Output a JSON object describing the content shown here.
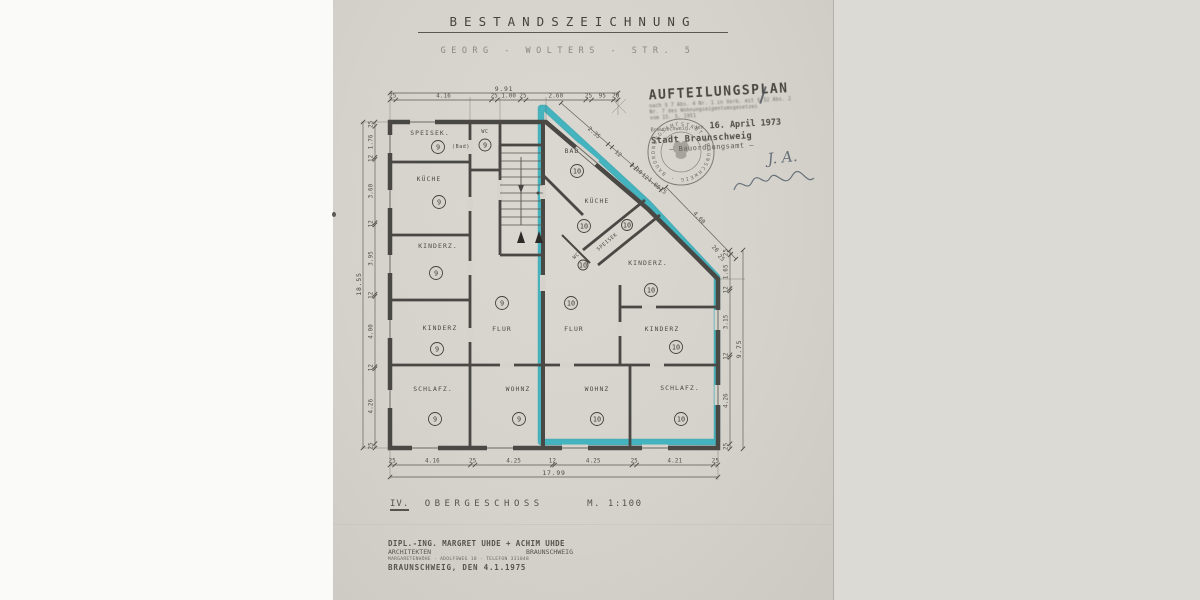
{
  "document": {
    "title": "BESTANDSZEICHNUNG",
    "address": "GEORG - WOLTERS - STR. 5",
    "floor_numeral": "IV.",
    "floor_name": "OBERGESCHOSS",
    "scale": "M. 1:100"
  },
  "approval_stamp": {
    "heading": "AUFTEILUNGSPLAN",
    "law_line_1": "nach § 7 Abs. 4 Nr. 1 in Verb. mit § 32 Abs. 2",
    "law_line_2": "Nr. 7 des Wohnungseigentumsgesetzes",
    "law_line_3": "vom 15. 3. 1951",
    "place_date_label": "Braunschweig, den",
    "date_stamped": "16. April 1973",
    "authority": "Stadt Braunschweig",
    "department": "— Bauordnungsamt —",
    "initials": "J. A.",
    "seal_text": "STADT BRAUNSCHWEIG · BAUORDNUNGSAMT"
  },
  "architect_stamp": {
    "line_1": "DIPL.-ING. MARGRET UHDE + ACHIM UHDE",
    "line_2_left": "ARCHITEKTEN",
    "line_2_right": "BRAUNSCHWEIG",
    "line_3": "MARGARETENHÖHE · ADOLFSWEG 18 · TELEFON 331048",
    "line_4": "BRAUNSCHWEIG, DEN 4.1.1975"
  },
  "plan": {
    "u9": "9",
    "u10": "10",
    "rooms": {
      "speisek9": "SPEISEK.",
      "bad9": "(Bad)",
      "wc9": "WC",
      "kueche9": "KÜCHE",
      "kinderz9a": "KINDERZ.",
      "kinderz9b": "KINDERZ",
      "flur9": "FLUR",
      "schlafz9": "SCHLAFZ.",
      "wohnz9": "WOHNZ",
      "bad10": "BAD",
      "kueche10": "KÜCHE",
      "speisek10": "SPEISEK",
      "wc10": "WC",
      "kinderz10a": "KINDERZ.",
      "kinderz10b": "KINDERZ",
      "flur10": "FLUR",
      "wohnz10": "WOHNZ",
      "schlafz10": "SCHLAFZ."
    },
    "dims": {
      "top": {
        "total": "9.91",
        "s": [
          "25",
          "4.16",
          "25",
          "1.00",
          "25",
          "2.60",
          "25",
          "95",
          "20"
        ]
      },
      "left": {
        "total": "18.55",
        "s": [
          "25",
          "1.76",
          "12",
          "3.60",
          "12",
          "3.95",
          "12",
          "4.00",
          "12",
          "4.26",
          "25"
        ]
      },
      "bottom": {
        "total": "17.99",
        "s": [
          "25",
          "4.16",
          "25",
          "4.25",
          "12",
          "4.25",
          "25",
          "4.21",
          "25"
        ]
      },
      "right": {
        "total": "9.75",
        "s": [
          "25",
          "1.65",
          "12",
          "3.15",
          "12",
          "4.26",
          "25"
        ]
      },
      "diag_upper": {
        "s": [
          "2.35",
          "12",
          "3.10",
          "12",
          "1.00",
          "25"
        ]
      },
      "diag_lower": {
        "s": [
          "4.60",
          "20",
          "25"
        ]
      }
    },
    "highlight_color": "#18a2b2",
    "ink_color": "#4a4844",
    "paper_color": "#d6d3cc"
  }
}
